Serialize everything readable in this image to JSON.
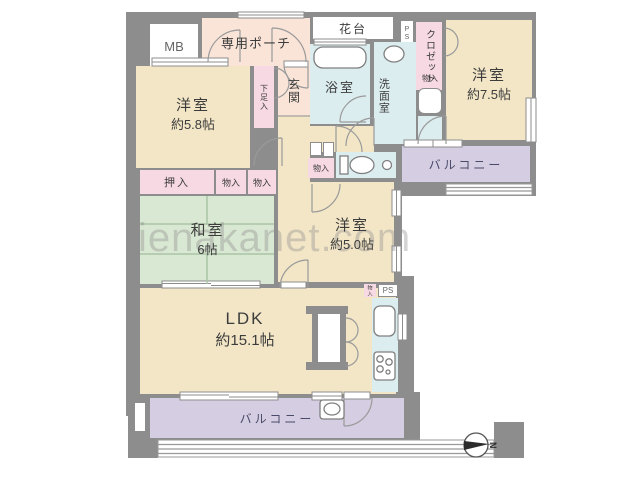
{
  "watermark": "ienakanet.com",
  "compass": {
    "label": "N"
  },
  "rooms": {
    "mb": "MB",
    "porch": "専用ポーチ",
    "hanadai": "花台",
    "ps_top": "PS",
    "closet": "クロゼット",
    "yoshitsu75": {
      "name": "洋室",
      "size": "約7.5帖"
    },
    "bath": "浴室",
    "wash": "洗面室",
    "mono_wash": "物入",
    "genkan": "玄関",
    "getabako": "下足入",
    "yoshitsu58": {
      "name": "洋室",
      "size": "約5.8帖"
    },
    "oshiire": "押入",
    "mono_a": "物入",
    "mono_b": "物入",
    "washitsu": {
      "name": "和室",
      "size": "6帖"
    },
    "mono_hall": "物入",
    "yoshitsu50": {
      "name": "洋室",
      "size": "約5.0帖"
    },
    "balcony_right": "バルコニー",
    "ldk": {
      "name": "LDK",
      "size": "約15.1帖"
    },
    "ps_bottom": "PS",
    "mono_kitchen": "物入",
    "balcony_bottom": "バルコニー"
  },
  "palette": {
    "wall": "#8d8d8d",
    "room_beige": "#f2e6c6",
    "tatami_green": "#d8e8d2",
    "wet_blue": "#dcedf0",
    "storage_pink": "#f7d9e3",
    "porch_peach": "#fae4d8",
    "balcony_purple": "#d5cee2"
  }
}
